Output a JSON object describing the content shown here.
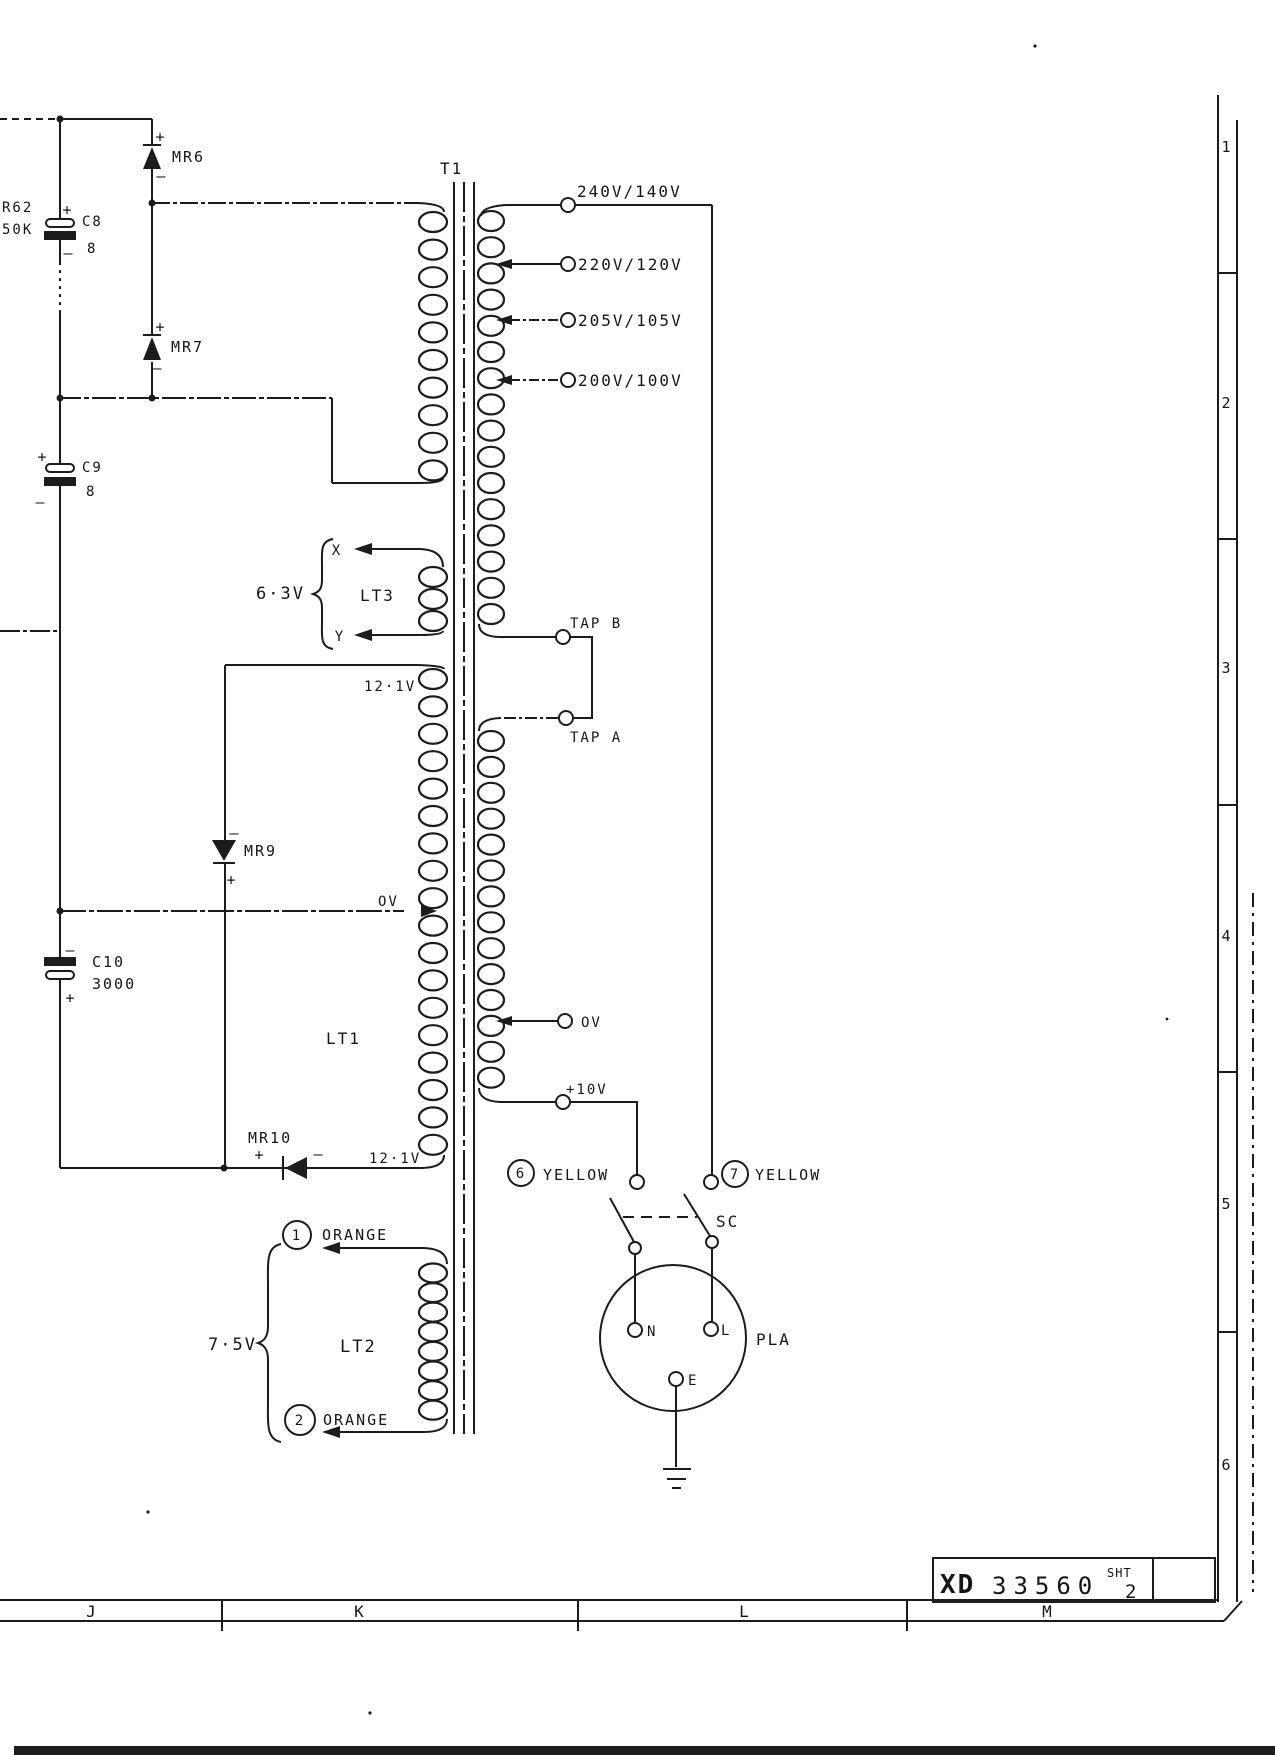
{
  "frame": {
    "row_numbers": [
      "1",
      "2",
      "3",
      "4",
      "5",
      "6"
    ],
    "column_letters": [
      "J",
      "K",
      "L",
      "M"
    ],
    "title_block": {
      "prefix": "XD",
      "number": "33560",
      "sheet_label": "SHT",
      "sheet_number": "2"
    }
  },
  "transformer": {
    "label": "T1",
    "taps": [
      "240V/140V",
      "220V/120V",
      "205V/105V",
      "200V/100V"
    ],
    "tap_b": "TAP B",
    "tap_a": "TAP A",
    "sec_zero": "OV",
    "sec_plus10": "+10V"
  },
  "lt3": {
    "label": "LT3",
    "voltage": "6·3V",
    "x": "X",
    "y": "Y"
  },
  "lt1": {
    "label": "LT1",
    "top_voltage": "12·1V",
    "zero": "OV",
    "bottom_voltage": "12·1V"
  },
  "lt2": {
    "label": "LT2",
    "voltage": "7·5V",
    "term1_num": "1",
    "term1_color": "ORANGE",
    "term2_num": "2",
    "term2_color": "ORANGE"
  },
  "rectifiers": {
    "mr6": "MR6",
    "mr7": "MR7",
    "mr9": "MR9",
    "mr10": "MR10"
  },
  "caps": {
    "c8": "C8",
    "c8_value": "8",
    "c9": "C9",
    "c9_value": "8",
    "c10": "C10",
    "c10_value": "3000"
  },
  "resistor": {
    "name": "R62",
    "value": "50K"
  },
  "mains": {
    "term6_num": "6",
    "term6_color": "YELLOW",
    "term7_num": "7",
    "term7_color": "YELLOW",
    "switch": "SC",
    "plug": "PLA",
    "pin_n": "N",
    "pin_l": "L",
    "pin_e": "E"
  },
  "sym": {
    "plus": "+",
    "minus": "–"
  }
}
